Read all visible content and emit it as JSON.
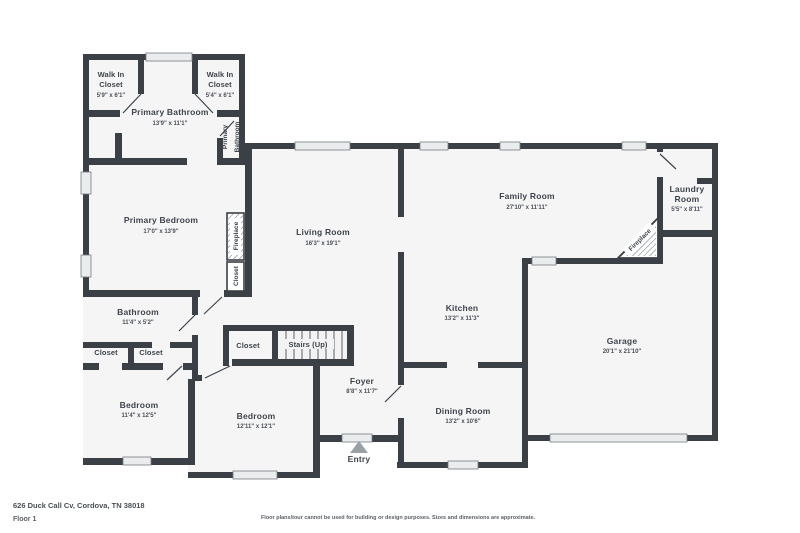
{
  "meta": {
    "address": "626 Duck Call Cv, Cordova, TN 38018",
    "floor_label": "Floor 1",
    "disclaimer": "Floor plans/tour cannot be used for building or design purposes. Sizes and dimensions are approximate."
  },
  "colors": {
    "wall": "#3b4046",
    "room_fill": "#f5f5f6",
    "background": "#ffffff",
    "window_fill": "#ebeced",
    "text": "#3f444b",
    "entry_arrow": "#9ba0a6"
  },
  "rooms": {
    "walk_in_closet_left": {
      "lines": [
        "Walk In",
        "Closet"
      ],
      "dims": "5'9\" x 6'1\""
    },
    "walk_in_closet_right": {
      "lines": [
        "Walk In",
        "Closet"
      ],
      "dims": "5'4\" x 6'1\""
    },
    "primary_bathroom": {
      "lines": [
        "Primary Bathroom"
      ],
      "dims": "13'9\" x 11'1\""
    },
    "primary_bathroom_wc": {
      "lines": [
        "Primary",
        "Bathroom"
      ]
    },
    "primary_bedroom": {
      "lines": [
        "Primary Bedroom"
      ],
      "dims": "17'0\" x 13'9\""
    },
    "living_room": {
      "lines": [
        "Living Room"
      ],
      "dims": "16'3\" x 19'1\""
    },
    "family_room": {
      "lines": [
        "Family Room"
      ],
      "dims": "27'10\" x 11'11\""
    },
    "laundry_room": {
      "lines": [
        "Laundry",
        "Room"
      ],
      "dims": "5'5\" x 8'11\""
    },
    "fireplace_corner": {
      "lines": [
        "Fireplace"
      ]
    },
    "fireplace_side": {
      "lines": [
        "Fireplace"
      ]
    },
    "closet_side": {
      "lines": [
        "Closet"
      ]
    },
    "kitchen": {
      "lines": [
        "Kitchen"
      ],
      "dims": "13'2\" x 11'3\""
    },
    "garage": {
      "lines": [
        "Garage"
      ],
      "dims": "20'1\" x 21'10\""
    },
    "dining_room": {
      "lines": [
        "Dining Room"
      ],
      "dims": "13'2\" x 10'6\""
    },
    "foyer": {
      "lines": [
        "Foyer"
      ],
      "dims": "8'8\" x 11'7\""
    },
    "entry": {
      "lines": [
        "Entry"
      ]
    },
    "stairs": {
      "lines": [
        "Stairs (Up)"
      ]
    },
    "hall_closet": {
      "lines": [
        "Closet"
      ]
    },
    "bathroom": {
      "lines": [
        "Bathroom"
      ],
      "dims": "11'4\" x 5'2\""
    },
    "closet_a": {
      "lines": [
        "Closet"
      ]
    },
    "closet_b": {
      "lines": [
        "Closet"
      ]
    },
    "bedroom_left": {
      "lines": [
        "Bedroom"
      ],
      "dims": "11'4\" x 12'5\""
    },
    "bedroom_right": {
      "lines": [
        "Bedroom"
      ],
      "dims": "12'11\" x 12'1\""
    }
  }
}
